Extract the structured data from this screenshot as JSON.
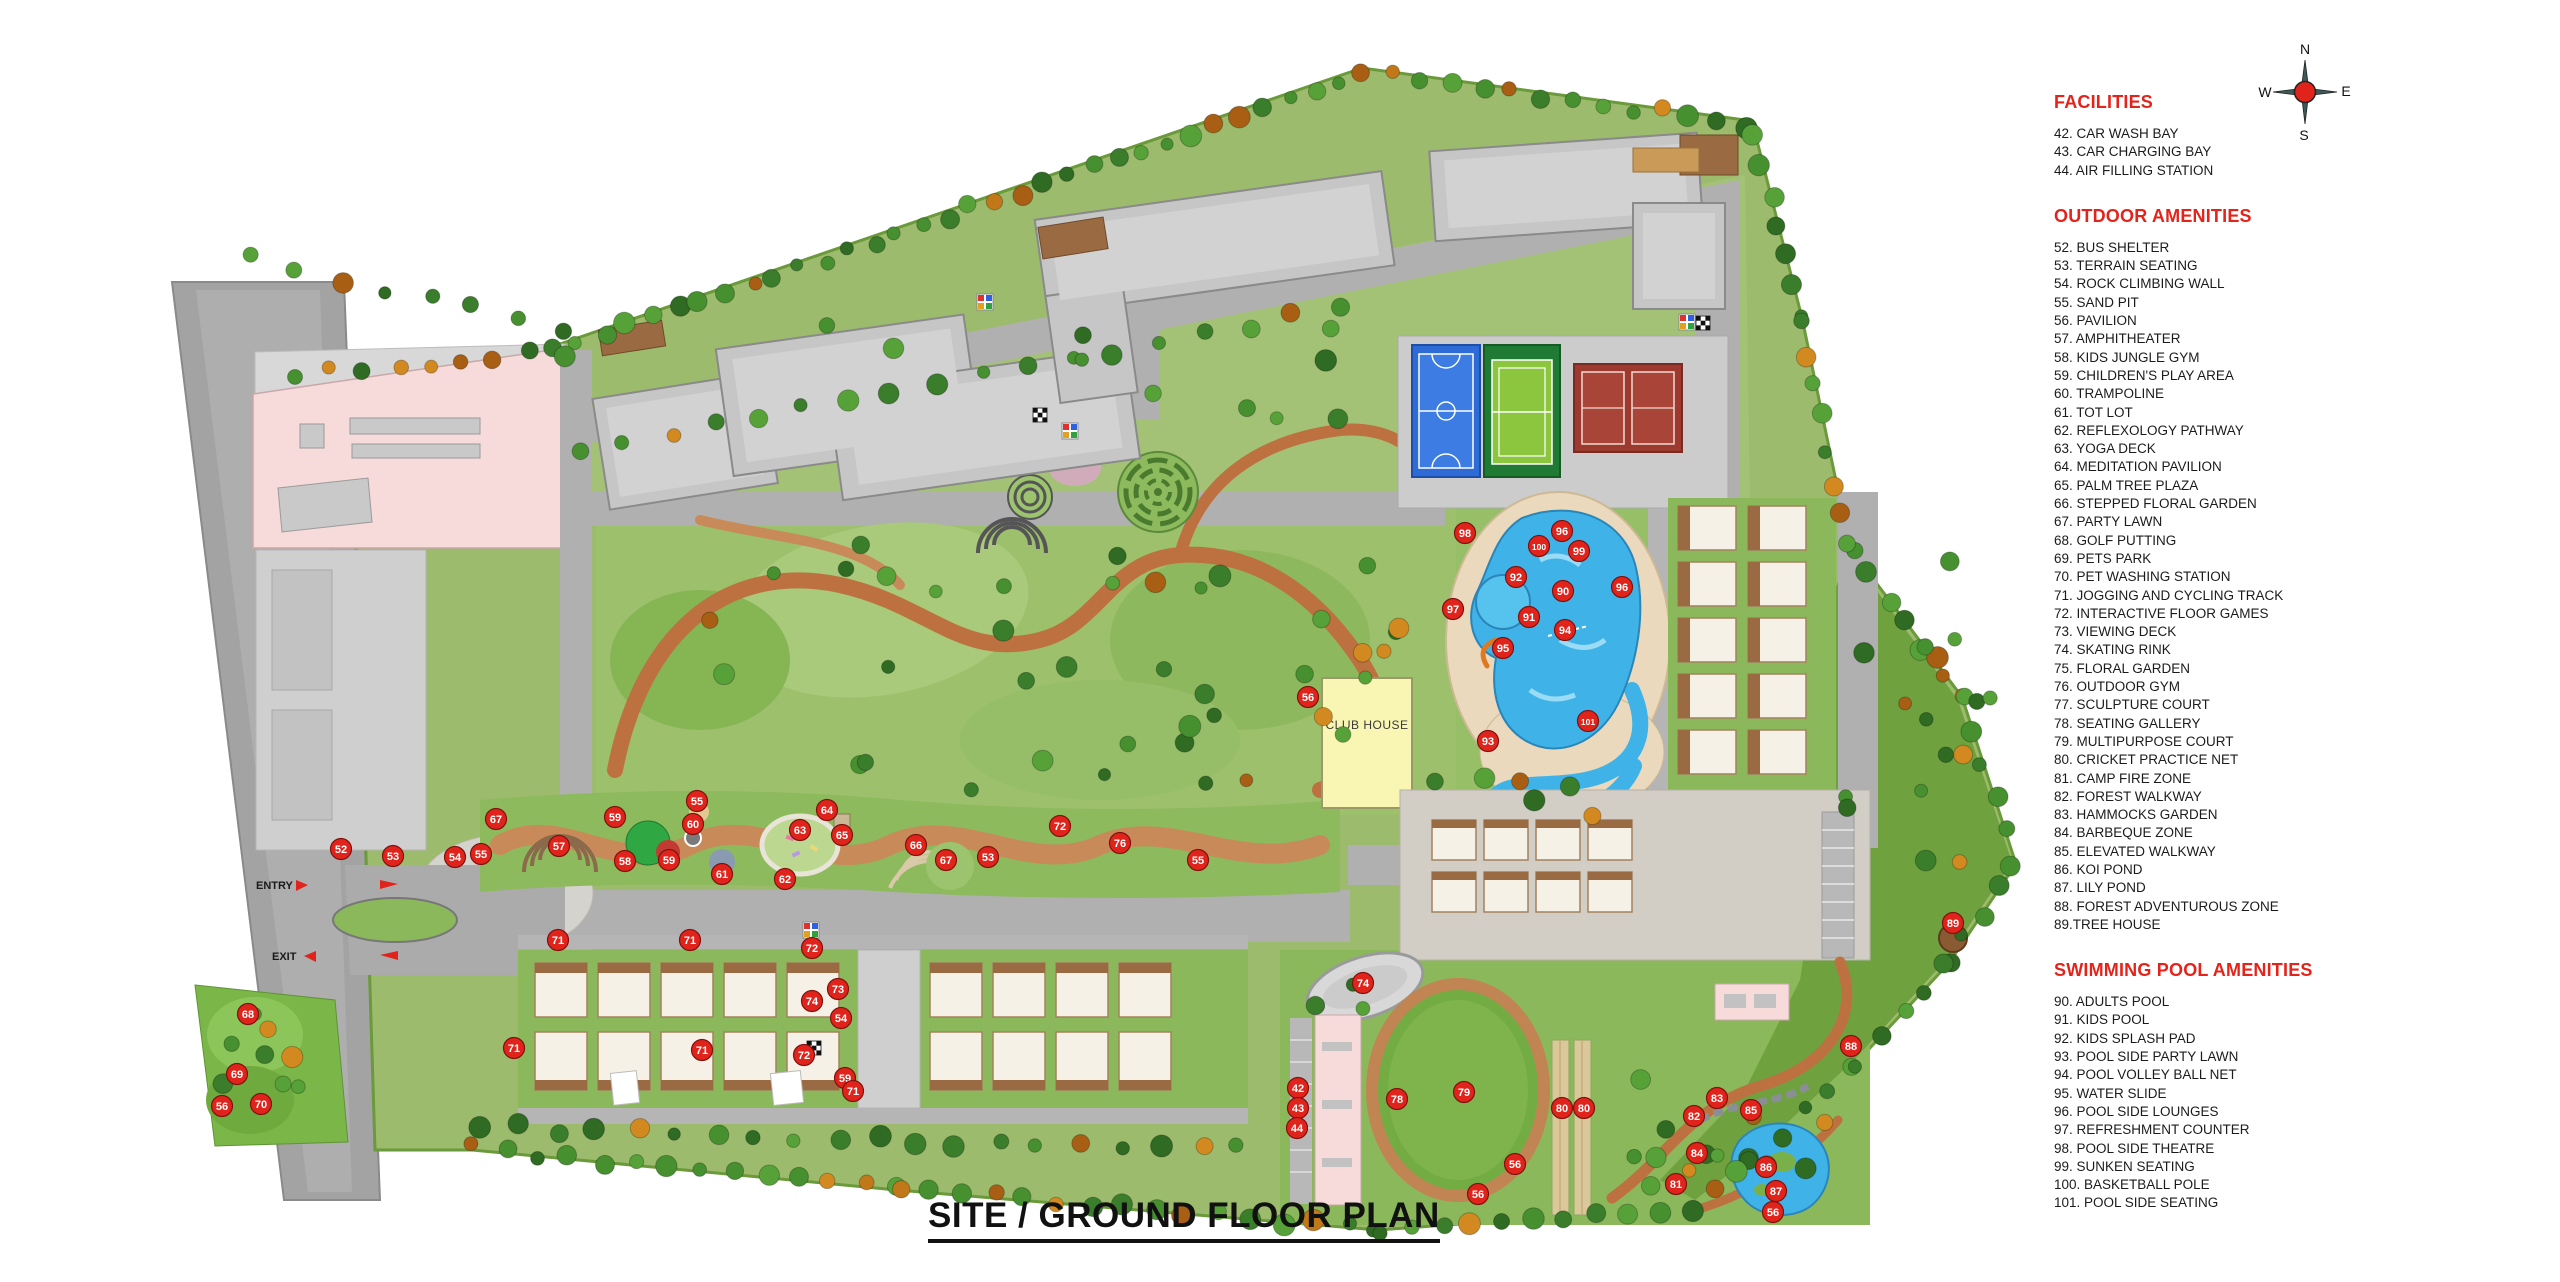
{
  "title": "SITE / GROUND FLOOR PLAN",
  "compass": {
    "north": "N",
    "east": "E",
    "south": "S",
    "west": "W"
  },
  "plan_labels": {
    "club_house": "CLUB HOUSE",
    "sports_club": "SPORTS CLUB",
    "entry": "ENTRY",
    "exit": "EXIT"
  },
  "legend": {
    "sections": [
      {
        "title": "FACILITIES",
        "items": [
          "42. CAR WASH BAY",
          "43. CAR CHARGING BAY",
          "44. AIR FILLING STATION"
        ]
      },
      {
        "title": "OUTDOOR AMENITIES",
        "items": [
          "52. BUS SHELTER",
          "53. TERRAIN SEATING",
          "54. ROCK CLIMBING WALL",
          "55. SAND PIT",
          "56. PAVILION",
          "57. AMPHITHEATER",
          "58. KIDS JUNGLE GYM",
          "59. CHILDREN'S PLAY AREA",
          "60. TRAMPOLINE",
          "61. TOT LOT",
          "62. REFLEXOLOGY PATHWAY",
          "63. YOGA DECK",
          "64. MEDITATION PAVILION",
          "65. PALM TREE PLAZA",
          "66. STEPPED FLORAL GARDEN",
          "67. PARTY LAWN",
          "68. GOLF PUTTING",
          "69. PETS PARK",
          "70. PET WASHING STATION",
          "71. JOGGING AND CYCLING TRACK",
          "72. INTERACTIVE FLOOR GAMES",
          "73. VIEWING DECK",
          "74. SKATING RINK",
          "75. FLORAL GARDEN",
          "76. OUTDOOR GYM",
          "77. SCULPTURE COURT",
          "78. SEATING GALLERY",
          "79. MULTIPURPOSE COURT",
          "80. CRICKET PRACTICE NET",
          "81. CAMP FIRE ZONE",
          "82. FOREST WALKWAY",
          "83. HAMMOCKS GARDEN",
          "84. BARBEQUE ZONE",
          "85. ELEVATED WALKWAY",
          "86. KOI POND",
          "87. LILY POND",
          "88. FOREST ADVENTUROUS ZONE",
          "89.TREE HOUSE"
        ]
      },
      {
        "title": "SWIMMING POOL AMENITIES",
        "items": [
          "90.  ADULTS POOL",
          "91.  KIDS POOL",
          "92.  KIDS SPLASH PAD",
          "93.  POOL SIDE PARTY LAWN",
          "94.  POOL VOLLEY BALL NET",
          "95.  WATER SLIDE",
          "96.  POOL SIDE LOUNGES",
          "97.  REFRESHMENT COUNTER",
          "98.  POOL SIDE THEATRE",
          "99.  SUNKEN SEATING",
          "100. BASKETBALL POLE",
          "101. POOL SIDE SEATING"
        ]
      }
    ]
  },
  "markers": [
    {
      "n": 52,
      "x": 341,
      "y": 849
    },
    {
      "n": 53,
      "x": 393,
      "y": 856
    },
    {
      "n": 54,
      "x": 455,
      "y": 857
    },
    {
      "n": 55,
      "x": 481,
      "y": 854
    },
    {
      "n": 67,
      "x": 496,
      "y": 819
    },
    {
      "n": 57,
      "x": 559,
      "y": 846
    },
    {
      "n": 59,
      "x": 615,
      "y": 817
    },
    {
      "n": 58,
      "x": 625,
      "y": 861
    },
    {
      "n": 59,
      "x": 669,
      "y": 860
    },
    {
      "n": 60,
      "x": 693,
      "y": 824
    },
    {
      "n": 55,
      "x": 697,
      "y": 801
    },
    {
      "n": 61,
      "x": 722,
      "y": 874
    },
    {
      "n": 62,
      "x": 785,
      "y": 879
    },
    {
      "n": 63,
      "x": 800,
      "y": 830
    },
    {
      "n": 64,
      "x": 827,
      "y": 810
    },
    {
      "n": 65,
      "x": 842,
      "y": 835
    },
    {
      "n": 66,
      "x": 916,
      "y": 845
    },
    {
      "n": 67,
      "x": 946,
      "y": 860
    },
    {
      "n": 53,
      "x": 988,
      "y": 857
    },
    {
      "n": 72,
      "x": 1060,
      "y": 826
    },
    {
      "n": 76,
      "x": 1120,
      "y": 843
    },
    {
      "n": 55,
      "x": 1198,
      "y": 860
    },
    {
      "n": 71,
      "x": 558,
      "y": 940
    },
    {
      "n": 71,
      "x": 690,
      "y": 940
    },
    {
      "n": 72,
      "x": 812,
      "y": 948
    },
    {
      "n": 73,
      "x": 838,
      "y": 989
    },
    {
      "n": 74,
      "x": 812,
      "y": 1001
    },
    {
      "n": 54,
      "x": 841,
      "y": 1018
    },
    {
      "n": 71,
      "x": 514,
      "y": 1048
    },
    {
      "n": 72,
      "x": 804,
      "y": 1055
    },
    {
      "n": 59,
      "x": 845,
      "y": 1078
    },
    {
      "n": 71,
      "x": 702,
      "y": 1050
    },
    {
      "n": 71,
      "x": 853,
      "y": 1091
    },
    {
      "n": 68,
      "x": 248,
      "y": 1014
    },
    {
      "n": 69,
      "x": 237,
      "y": 1074
    },
    {
      "n": 56,
      "x": 222,
      "y": 1106
    },
    {
      "n": 70,
      "x": 261,
      "y": 1104
    },
    {
      "n": 98,
      "x": 1465,
      "y": 533
    },
    {
      "n": 100,
      "x": 1539,
      "y": 546
    },
    {
      "n": 96,
      "x": 1562,
      "y": 531
    },
    {
      "n": 99,
      "x": 1579,
      "y": 551
    },
    {
      "n": 92,
      "x": 1516,
      "y": 577
    },
    {
      "n": 90,
      "x": 1563,
      "y": 591
    },
    {
      "n": 91,
      "x": 1529,
      "y": 617
    },
    {
      "n": 94,
      "x": 1565,
      "y": 630
    },
    {
      "n": 95,
      "x": 1503,
      "y": 648
    },
    {
      "n": 96,
      "x": 1622,
      "y": 587
    },
    {
      "n": 97,
      "x": 1453,
      "y": 609
    },
    {
      "n": 93,
      "x": 1488,
      "y": 741
    },
    {
      "n": 101,
      "x": 1588,
      "y": 721
    },
    {
      "n": 56,
      "x": 1308,
      "y": 697
    },
    {
      "n": 74,
      "x": 1363,
      "y": 983
    },
    {
      "n": 78,
      "x": 1397,
      "y": 1099
    },
    {
      "n": 79,
      "x": 1464,
      "y": 1092
    },
    {
      "n": 80,
      "x": 1562,
      "y": 1108
    },
    {
      "n": 80,
      "x": 1584,
      "y": 1108
    },
    {
      "n": 56,
      "x": 1515,
      "y": 1164
    },
    {
      "n": 56,
      "x": 1478,
      "y": 1194
    },
    {
      "n": 42,
      "x": 1298,
      "y": 1088
    },
    {
      "n": 43,
      "x": 1298,
      "y": 1108
    },
    {
      "n": 44,
      "x": 1297,
      "y": 1128
    },
    {
      "n": 83,
      "x": 1717,
      "y": 1098
    },
    {
      "n": 82,
      "x": 1694,
      "y": 1116
    },
    {
      "n": 85,
      "x": 1751,
      "y": 1110
    },
    {
      "n": 84,
      "x": 1697,
      "y": 1153
    },
    {
      "n": 81,
      "x": 1676,
      "y": 1184
    },
    {
      "n": 86,
      "x": 1766,
      "y": 1167
    },
    {
      "n": 87,
      "x": 1776,
      "y": 1191
    },
    {
      "n": 88,
      "x": 1851,
      "y": 1046
    },
    {
      "n": 56,
      "x": 1773,
      "y": 1212
    },
    {
      "n": 89,
      "x": 1953,
      "y": 923
    }
  ],
  "colors": {
    "legend_heading_red": "#e5231b",
    "marker_red": "#e0241c",
    "pool_blue": "#3fb3e8",
    "club_yellow": "#f8f6b2",
    "building_gray": "#c6c6c6",
    "path_terracotta": "#bd7140",
    "landscape_green": "#9dbb6d",
    "pink_zone": "#f7dada"
  }
}
